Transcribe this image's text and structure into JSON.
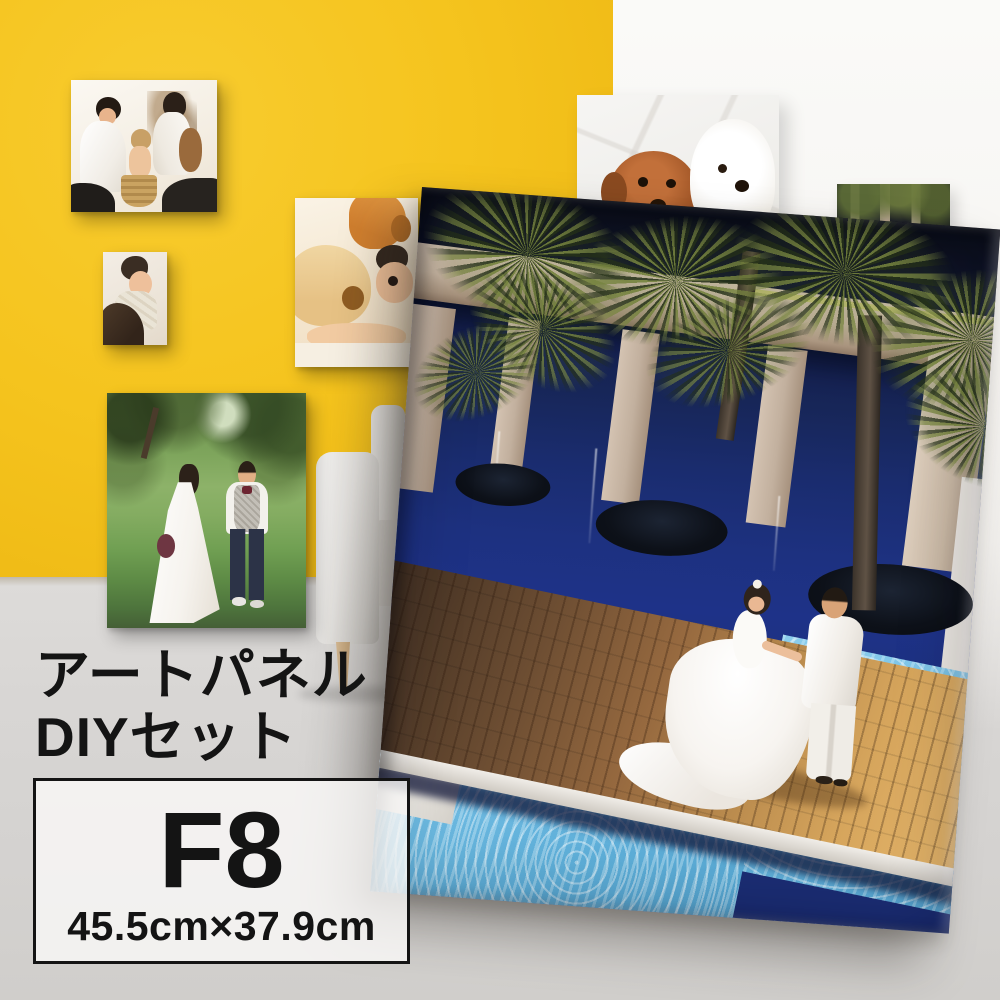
{
  "caption": {
    "line1": "アートパネル",
    "line2": "DIYセット"
  },
  "size_box": {
    "code": "F8",
    "dimensions": "45.5cm×37.9cm"
  },
  "theme": {
    "wall_yellow": "#f5c41e",
    "wall_white": "#f7f5f2",
    "floor": "#d9d7d5",
    "ink": "#141414",
    "pool_navy": "#1e3288",
    "pool_light": "#6fbde4",
    "wood_light": "#e0ab62",
    "beige": "#c6b4a2",
    "palm": "#5a6b38",
    "canvas_white": "#f4f1ec"
  }
}
